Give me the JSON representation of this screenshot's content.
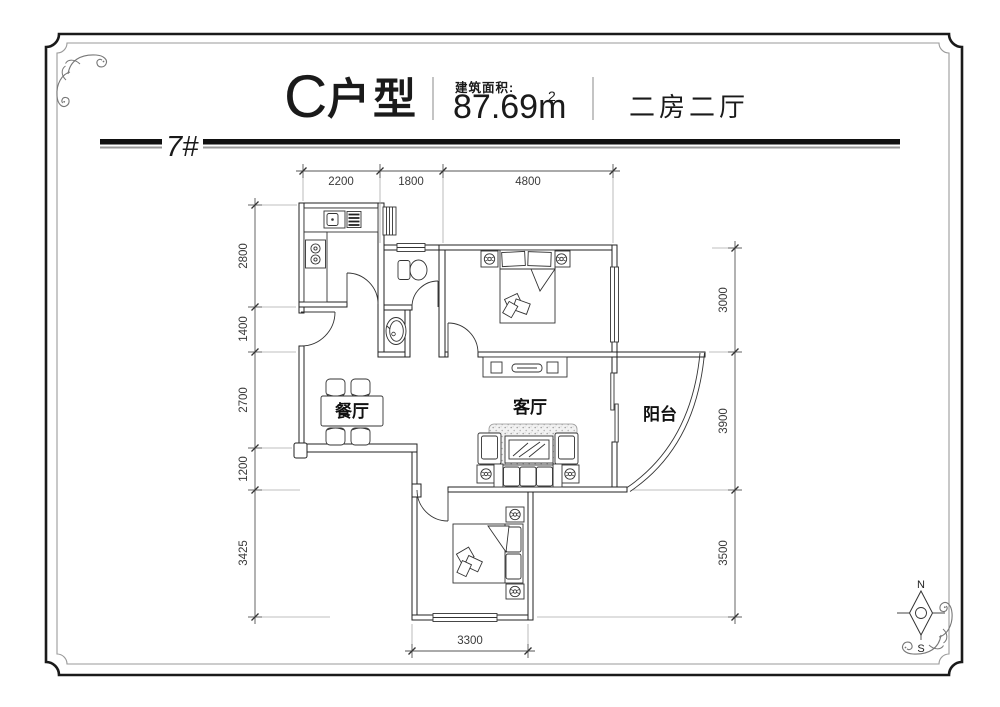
{
  "header": {
    "unit_letter": "C",
    "unit_word": "户型",
    "area_label": "建筑面积:",
    "area_value": "87.69m",
    "area_exponent": "2",
    "layout_type": "二房二厅"
  },
  "building_bar": {
    "label": "7#"
  },
  "floor_plan": {
    "room_labels": {
      "dining": "餐厅",
      "living": "客厅",
      "balcony": "阳台"
    },
    "dimensions_mm": {
      "top": [
        "2200",
        "1800",
        "4800"
      ],
      "left": [
        "2800",
        "1400",
        "2700",
        "1200",
        "3425"
      ],
      "right": [
        "3000",
        "3900",
        "3500"
      ],
      "bottom": [
        "3300"
      ]
    },
    "compass": {
      "north": "N",
      "south": "S"
    }
  },
  "colors": {
    "line": "#222222",
    "dimension": "#555555",
    "frame_outer": "#1a1a1a",
    "frame_inner": "#9a9a9a",
    "bar_black": "#111111",
    "bar_gray": "#999999",
    "background": "#ffffff"
  }
}
